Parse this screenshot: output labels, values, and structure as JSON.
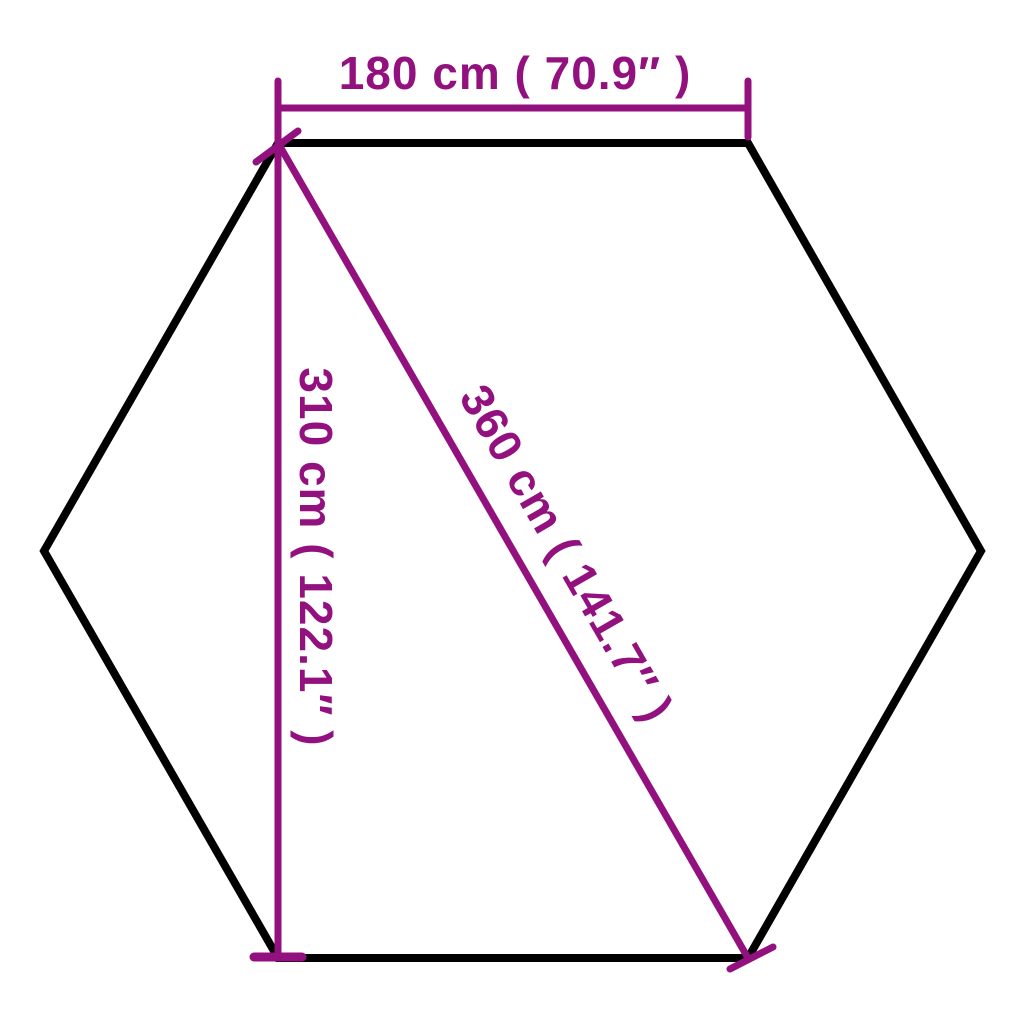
{
  "diagram": {
    "type": "hexagon-dimension-diagram",
    "background_color": "#FFFFFF",
    "colors": {
      "outline": "#000000",
      "dimension": "#93117E"
    },
    "shape": "hexagon",
    "dimensions": {
      "top_width": {
        "label": "180 cm ( 70.9″ )",
        "cm": 180,
        "inches": 70.9
      },
      "height": {
        "label": "310 cm ( 122.1″ )",
        "cm": 310,
        "inches": 122.1
      },
      "diagonal": {
        "label": "360 cm ( 141.7″ )",
        "cm": 360,
        "inches": 141.7
      }
    }
  }
}
